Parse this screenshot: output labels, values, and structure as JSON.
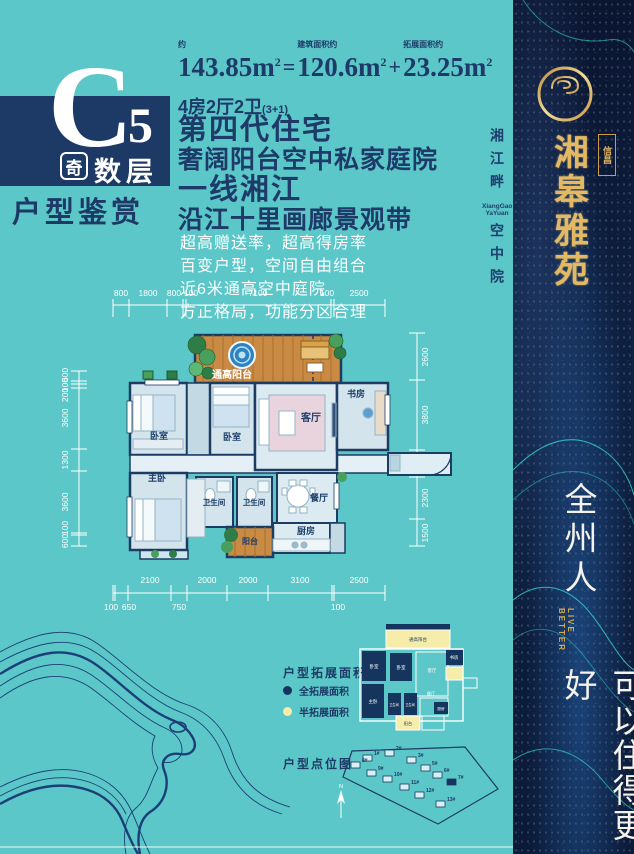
{
  "badge": {
    "letter": "C",
    "number": "5",
    "odd_label": "奇",
    "floors_label": "数层",
    "subtitle": "户型鉴赏"
  },
  "stats": {
    "approx_label": "约",
    "total_area": "143.85",
    "unit": "m",
    "sup": "2",
    "equals": "=",
    "built_label": "建筑面积约",
    "built_area": "120.6",
    "plus": "+",
    "expand_label": "拓展面积约",
    "expand_area": "23.25",
    "layout": "4房2厅2卫",
    "layout_note": "(3+1)"
  },
  "headlines": {
    "line1": "第四代住宅",
    "line2": "奢阔阳台空中私家庭院",
    "line3": "一线湘江",
    "line4": "沿江十里画廊景观带"
  },
  "features": {
    "line1": "超高赠送率，超高得房率",
    "line2": "百变户型，空间自由组合",
    "line3": "近6米通高空中庭院",
    "line4": "方正格局，功能分区合理"
  },
  "floorplan": {
    "dims_top": [
      "800",
      "1800",
      "800",
      "100",
      "7100",
      "100",
      "2500"
    ],
    "dims_left": [
      "600",
      "100",
      "200",
      "3600",
      "1300",
      "3600",
      "100",
      "600"
    ],
    "dims_right": [
      "2600",
      "3800",
      "1500",
      "2300",
      "1500"
    ],
    "dims_bottom_row1": [
      "2100",
      "2000",
      "2000",
      "3100",
      "100",
      "2500"
    ],
    "dims_bottom_row2": [
      "100",
      "650",
      "750"
    ],
    "rooms": {
      "terrace": "通高阳台",
      "bedroom_left": "卧室",
      "bedroom_mid": "卧室",
      "living": "客厅",
      "study": "书房",
      "master": "主卧",
      "bath_left": "卫生间",
      "bath_right": "卫生间",
      "dining": "餐厅",
      "kitchen": "厨房",
      "balcony": "阳台"
    }
  },
  "expansion": {
    "title": "户型拓展面积",
    "legend_full": "全拓展面积",
    "legend_half": "半拓展面积"
  },
  "sitemap": {
    "title": "户型点位图",
    "north": "N",
    "buildings": [
      "1#",
      "2#",
      "3#",
      "5#",
      "6#",
      "7#",
      "8#",
      "9#",
      "10#",
      "11#",
      "12#",
      "13#"
    ]
  },
  "strip": {
    "line1": "湘江畔",
    "en_line1": "XiangGao",
    "en_line2": "YaYuan",
    "line2": "空中院"
  },
  "sidebar": {
    "company": "信昌",
    "brand": "湘皋雅苑",
    "slogan_1": "全州人",
    "slogan_en_1": "LIVE",
    "slogan_en_2": "BETTER",
    "slogan_2": "可以住得更好"
  },
  "colors": {
    "teal_bg": "#5cc7c8",
    "navy": "#1d3a66",
    "gold": "#ddb05e",
    "wood": "#c98a43",
    "full_extend": "#16355e",
    "half_extend": "#f6edaa",
    "sidebar_dark": "#0b1a38"
  }
}
